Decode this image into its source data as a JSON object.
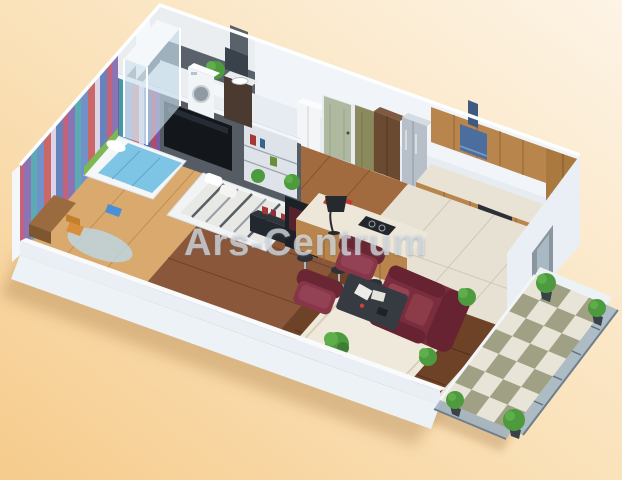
{
  "watermark": {
    "text": "Ars-Centrum"
  },
  "background": {
    "top_right": "#FDF4E6",
    "middle": "#FAE0B6",
    "bottom_left": "#F6CB8C"
  },
  "palette": {
    "wall_white": "#F1F5F9",
    "kids_wall_stripes": [
      "#C0504E",
      "#D6CEE4",
      "#4F6FB0",
      "#B84A66",
      "#7A5CA8",
      "#3F9EA8",
      "#5B7FBF"
    ],
    "kids_bed_blanket": "#7EC4E4",
    "kids_headboard": "#7CB854",
    "kids_desk_chair": "#D98E3B",
    "bathroom_tile_dark": "#59616B",
    "bathroom_floor": "#C9D5DA",
    "master_partition": "#565C64",
    "tv_screen": "#13171C",
    "master_floor": "#8A573A",
    "hall_floor": "#A26B3F",
    "kitchen_cabinets": "#B8854C",
    "range_hood_blue": "#4C6E9E",
    "kitchen_floor_tile": "#E7E1D3",
    "living_floor": "#6E4226",
    "rug_cream": "#EFE9DB",
    "sofa_leather": "#7A2D3C",
    "coffee_table": "#363B42",
    "balcony_tile_light": "#E8E4D8",
    "balcony_tile_dark": "#9FA084",
    "railing_glass": "#9FB4C4",
    "plant_green": "#4E9A3E",
    "ground_shadow": "rgba(150,100,50,0.30)"
  },
  "scene": {
    "type": "isometric-3d-apartment-floor-plan-render",
    "rooms": [
      "kids-bedroom",
      "bathroom",
      "hallway",
      "master-bedroom",
      "kitchen-dining",
      "living-room",
      "balcony"
    ],
    "objects": [
      "kids-bed",
      "kids-desk",
      "shower-cabin",
      "washing-machine",
      "vanity-sink",
      "tv-panel",
      "master-bed",
      "media-console",
      "kitchen-island",
      "bar-stools",
      "range-hood",
      "fridge",
      "oven",
      "sofa",
      "armchairs",
      "coffee-table",
      "floor-lamp",
      "potted-plants",
      "checkerboard-balcony",
      "glass-railing"
    ]
  }
}
